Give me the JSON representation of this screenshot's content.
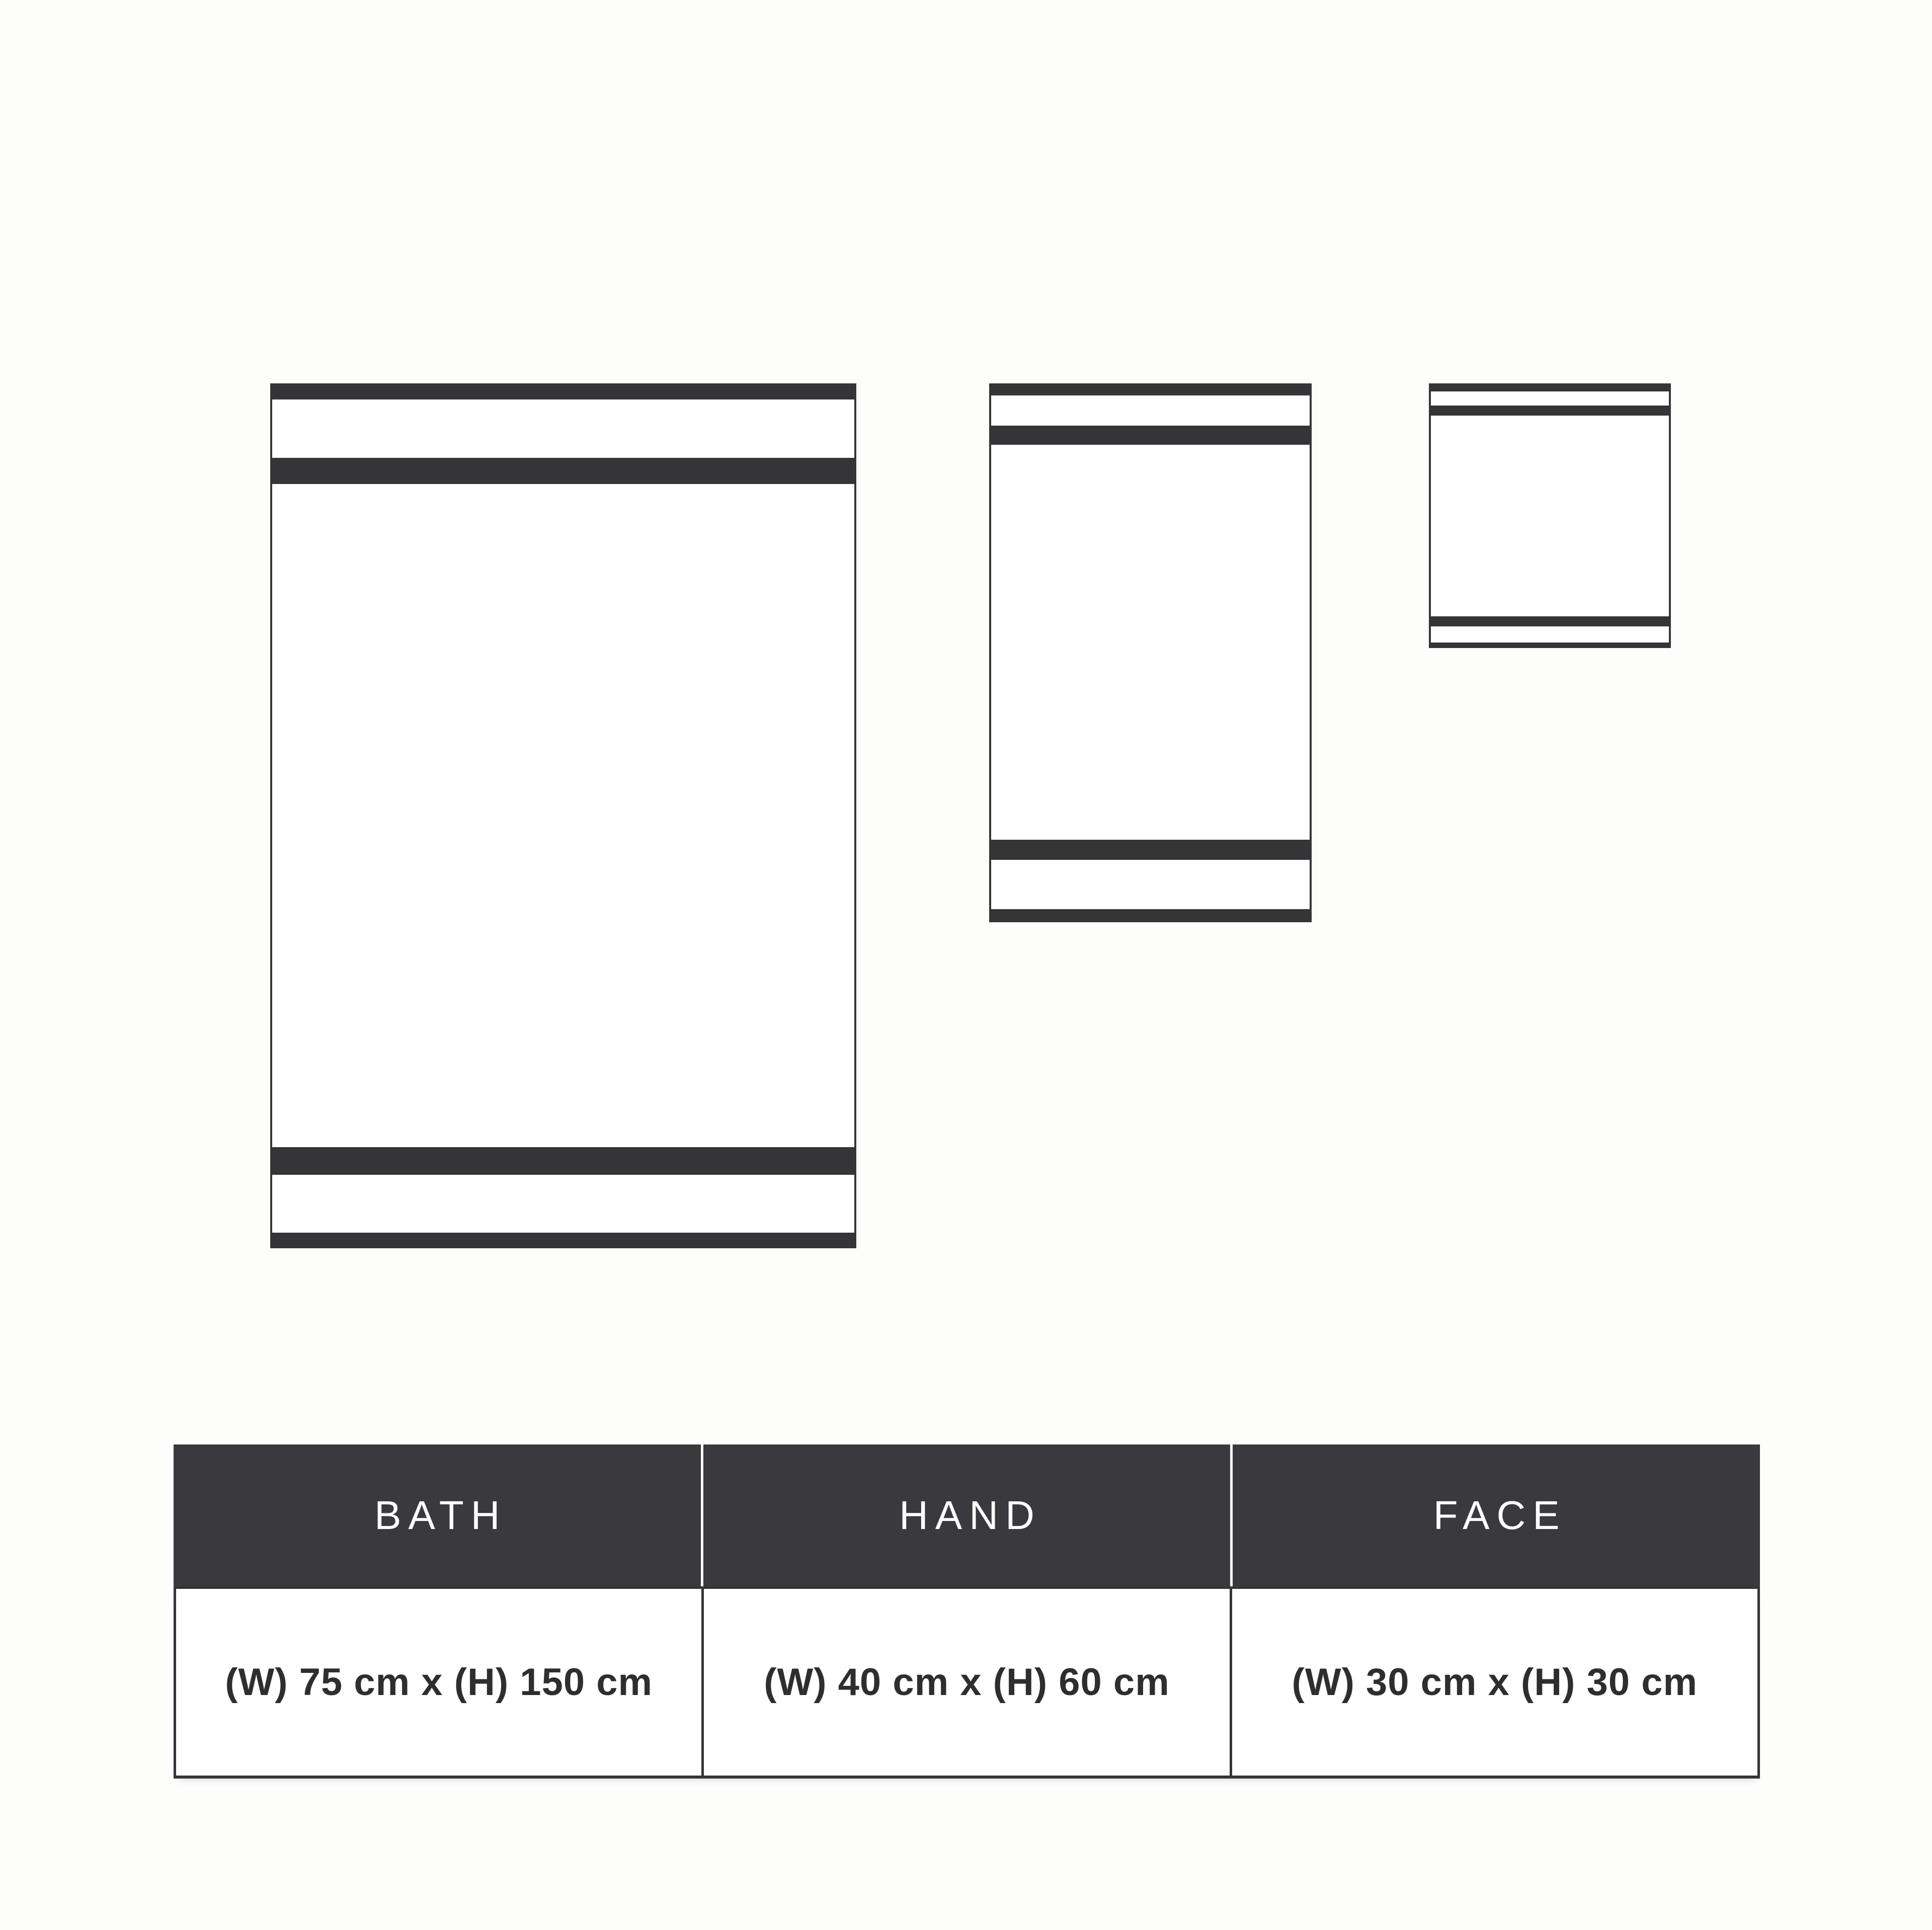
{
  "colors": {
    "background": "#fdfdfc",
    "stripe": "#353538",
    "header_bg": "#3a3a3e",
    "header_text": "#ffffff",
    "body_text": "#2e2e30",
    "towel_fill": "#ffffff"
  },
  "towel_diagram": {
    "towels": [
      {
        "name": "bath-towel-illustration"
      },
      {
        "name": "hand-towel-illustration"
      },
      {
        "name": "face-towel-illustration"
      }
    ]
  },
  "size_table": {
    "columns": [
      {
        "header": "BATH",
        "dimensions": "(W) 75 cm x (H) 150 cm"
      },
      {
        "header": "HAND",
        "dimensions": "(W) 40 cm x (H) 60 cm"
      },
      {
        "header": "FACE",
        "dimensions": "(W) 30 cm x (H) 30 cm"
      }
    ]
  }
}
